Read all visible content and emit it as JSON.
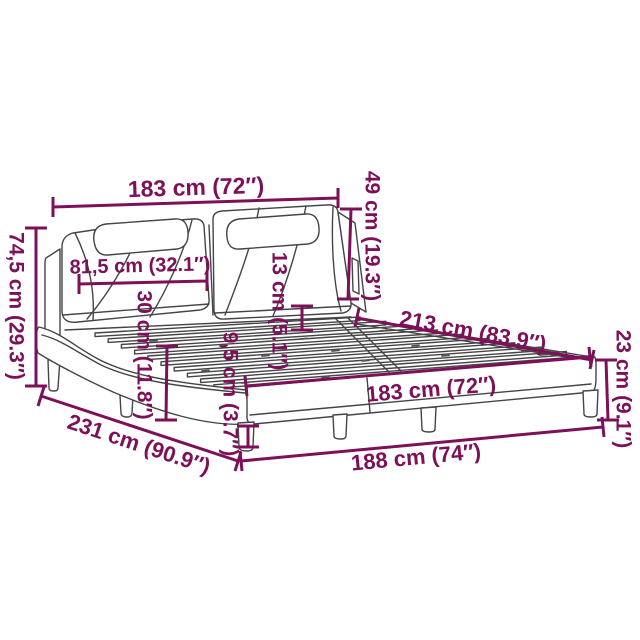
{
  "colors": {
    "dimension": "#7d1058",
    "line_art": "#454545",
    "background": "#ffffff"
  },
  "diagram": {
    "subject": "bed-frame-with-headboard-dimension-diagram",
    "labels": {
      "headboard_width": "183 cm (72″)",
      "headboard_height": "49 cm (19.3″)",
      "total_height": "74,5 cm (29.3″)",
      "cushion_width": "81,5 cm (32.1″)",
      "headrest_drop": "30 cm (11.8″)",
      "cushion_thickness": "13 cm (5.1″)",
      "leg_height": "9,5 cm (3.7″)",
      "frame_length": "213 cm (83.9″)",
      "inner_width": "183 cm (72″)",
      "frame_height": "23 cm (9.1″)",
      "total_length": "231 cm (90.9″)",
      "total_width": "188 cm (74″)"
    }
  }
}
